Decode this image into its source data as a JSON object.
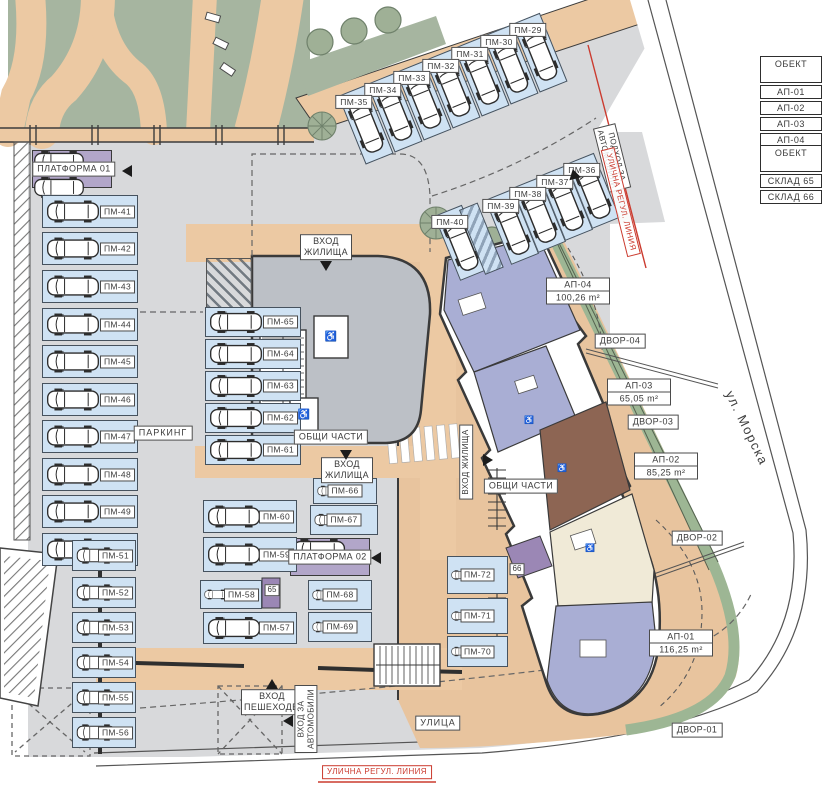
{
  "legend_tables": [
    {
      "header": "ОБЕКТ",
      "rows": [
        "АП-01",
        "АП-02",
        "АП-03",
        "АП-04"
      ]
    },
    {
      "header": "ОБЕКТ",
      "rows": [
        "СКЛАД 65",
        "СКЛАД 66"
      ]
    }
  ],
  "parking": {
    "area_label": "ПАРКИНГ",
    "platform_1": "ПЛАТФОРМА 01",
    "platform_2": "ПЛАТФОРМА 02",
    "row_top": [
      "ПМ-29",
      "ПМ-30",
      "ПМ-31",
      "ПМ-32",
      "ПМ-33",
      "ПМ-34",
      "ПМ-35"
    ],
    "row_second": [
      "ПМ-36",
      "ПМ-37",
      "ПМ-38",
      "ПМ-39",
      "ПМ-40"
    ],
    "col_left": [
      "ПМ-41",
      "ПМ-42",
      "ПМ-43",
      "ПМ-44",
      "ПМ-45",
      "ПМ-46",
      "ПМ-47",
      "ПМ-48",
      "ПМ-49",
      "ПМ-50"
    ],
    "col_left_lower": [
      "ПМ-51",
      "ПМ-52",
      "ПМ-53",
      "ПМ-54",
      "ПМ-55",
      "ПМ-56"
    ],
    "col_mid_left": [
      "ПМ-65",
      "ПМ-64",
      "ПМ-63",
      "ПМ-62",
      "ПМ-61"
    ],
    "col_mid_left2": [
      "ПМ-60",
      "ПМ-59",
      "ПМ-58",
      "ПМ-57"
    ],
    "col_mid_right": [
      "ПМ-66",
      "ПМ-67"
    ],
    "col_mid_right2": [
      "ПМ-68",
      "ПМ-69"
    ],
    "col_bottom": [
      "ПМ-72",
      "ПМ-71",
      "ПМ-70"
    ]
  },
  "apartments": [
    {
      "id": "АП-01",
      "area": "116,25 m²"
    },
    {
      "id": "АП-02",
      "area": "85,25 m²"
    },
    {
      "id": "АП-03",
      "area": "65,05 m²"
    },
    {
      "id": "АП-04",
      "area": "100,26 m²"
    }
  ],
  "yards": [
    "ДВОР-01",
    "ДВОР-02",
    "ДВОР-03",
    "ДВОР-04"
  ],
  "common_areas": [
    "ОБЩИ ЧАСТИ",
    "ОБЩИ ЧАСТИ"
  ],
  "entrances": {
    "residential_top": "ВХОД ЖИЛИЩА",
    "residential_mid": "ВХОД ЖИЛИЩА",
    "residential_right": "ВХОД ЖИЛИЩА",
    "pedestrian": "ВХОД ПЕШЕХОДЕН",
    "vehicles": "ВХОД ЗА АВТОМОБИЛИ",
    "vehicle_approach": "ПОДХОД ЗА АВТОМОБИЛИ"
  },
  "streets": {
    "street": "УЛИЦА",
    "morska": "ул. Морска",
    "regulation_top": "УЛИЧНА РЕГУЛ. ЛИНИЯ",
    "regulation_bottom": "УЛИЧНА РЕГУЛ. ЛИНИЯ"
  },
  "storage": {
    "s65": "65",
    "s66": "66"
  },
  "icons": {
    "wheelchair": "♿"
  },
  "colors": {
    "park_green": "#a6b5a0",
    "path_tan": "#ecc9a3",
    "asphalt": "#d8d9db",
    "spot_blue": "#cfe2f3",
    "platform_purple": "#b2a6c9",
    "plot_tan": "#e8c49e",
    "hedge_green": "#9db694",
    "room_blue": "#a9aed4",
    "room_brown": "#8d6553",
    "room_cream": "#f0ead7",
    "storage_purple": "#9b87b5",
    "regulation_red": "#cb3b2f"
  }
}
